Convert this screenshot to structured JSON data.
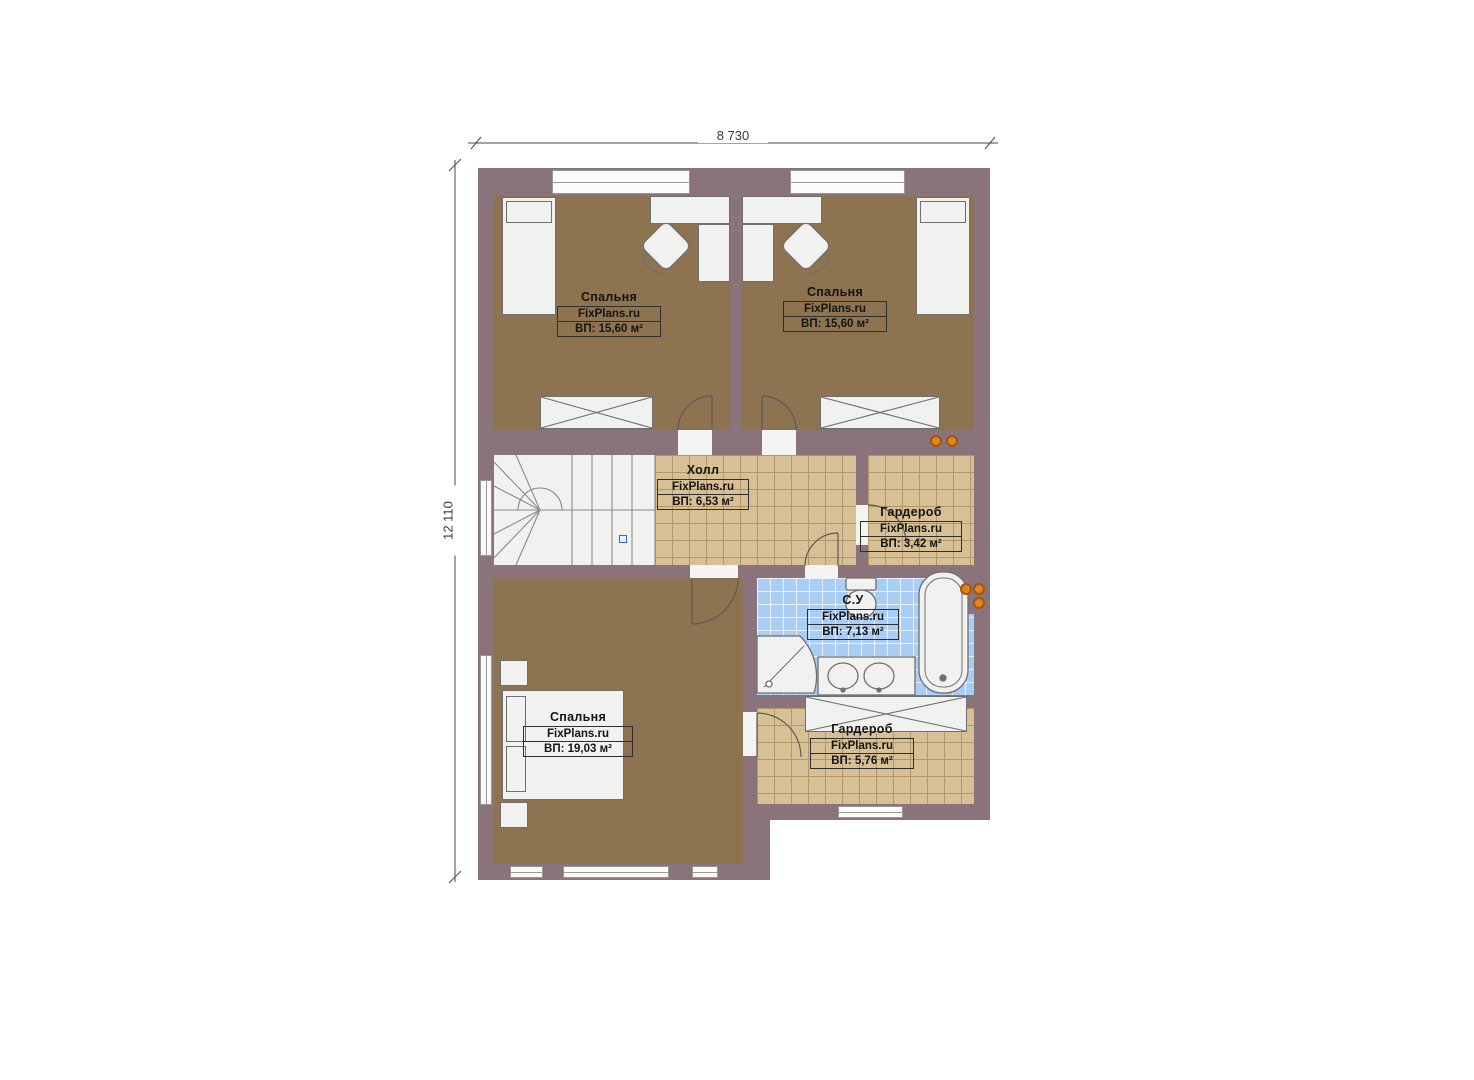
{
  "dimensions": {
    "width_label": "8 730",
    "height_label": "12 110"
  },
  "watermark": "FixPlans.ru",
  "rooms": [
    {
      "id": "bedroom-top-left",
      "name": "Спальня",
      "watermark": "FixPlans.ru",
      "area": "ВП: 15,60 м²"
    },
    {
      "id": "bedroom-top-right",
      "name": "Спальня",
      "watermark": "FixPlans.ru",
      "area": "ВП: 15,60 м²"
    },
    {
      "id": "hall",
      "name": "Холл",
      "watermark": "FixPlans.ru",
      "area": "ВП: 6,53 м²"
    },
    {
      "id": "wardrobe-right",
      "name": "Гардероб",
      "watermark": "FixPlans.ru",
      "area": "ВП: 3,42 м²"
    },
    {
      "id": "bathroom",
      "name": "С.У",
      "watermark": "FixPlans.ru",
      "area": "ВП: 7,13 м²"
    },
    {
      "id": "bedroom-bottom",
      "name": "Спальня",
      "watermark": "FixPlans.ru",
      "area": "ВП: 19,03 м²"
    },
    {
      "id": "wardrobe-bottom",
      "name": "Гардероб",
      "watermark": "FixPlans.ru",
      "area": "ВП: 5,76 м²"
    }
  ],
  "colors": {
    "wall": "#8a737a",
    "carpet": "#8d734f",
    "tile": "#d7c095",
    "tile_line": "#b19768",
    "bath_tile": "#a9cdf3",
    "bath_line": "#e9f2fc",
    "furniture": "#f1f1ef",
    "furniture_stroke": "#6f6f6f",
    "radiator": "#e2821c",
    "marker_blue": "#3a66c4",
    "dimension": "#3a3a3a"
  }
}
